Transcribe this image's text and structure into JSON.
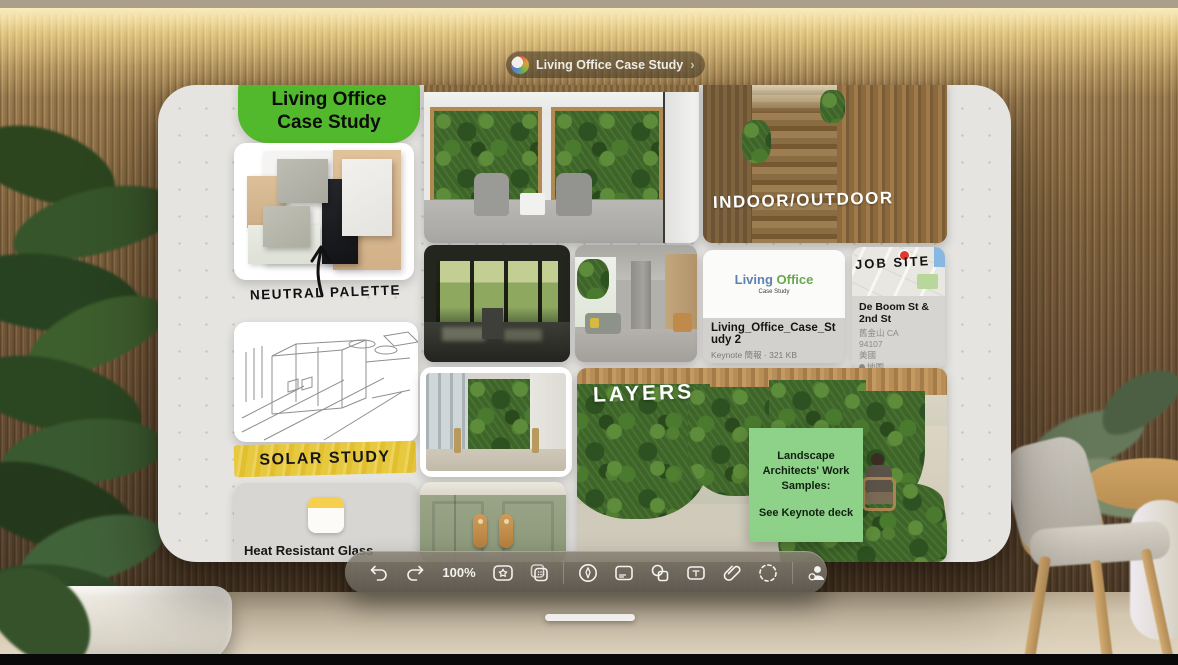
{
  "window_pill": {
    "title": "Living Office Case Study",
    "chevron": "›",
    "icon": "freeform-app-icon"
  },
  "toolbar": {
    "zoom_level": "100%",
    "icons": [
      "undo-icon",
      "redo-icon",
      "insert-favorites-icon",
      "duplicate-board-icon",
      "draw-icon",
      "sticky-note-icon",
      "shapes-icon",
      "text-box-icon",
      "attachment-icon",
      "selection-icon",
      "collaborate-icon"
    ]
  },
  "board": {
    "title_shape": {
      "line1": "Living Office",
      "line2": "Case Study",
      "color": "#53b92c"
    },
    "labels": {
      "neutral_palette": "NEUTRAL PALETTE",
      "solar_study": "SOLAR STUDY",
      "indoor_outdoor": "INDOOR/OUTDOOR",
      "job_site": "JOB SITE",
      "layers": "LAYERS"
    },
    "highlight_color": "#e7c93f",
    "note_file": {
      "title": "Heat Resistant Glass",
      "app": "備忘錄"
    },
    "keynote_file": {
      "brand_living": "Living",
      "brand_office": "Office",
      "brand_sub": "Case Study",
      "filename": "Living_Office_Case_Study 2",
      "meta": "Keynote 簡報 · 321 KB"
    },
    "map_card": {
      "title": "De Boom St & 2nd St",
      "city": "舊金山 CA",
      "zip": "94107",
      "country": "美國",
      "source": "地圖"
    },
    "green_sticky": {
      "color": "#8ed189",
      "p1": "Landscape Architects' Work Samples:",
      "p2": "See Keynote deck"
    }
  }
}
